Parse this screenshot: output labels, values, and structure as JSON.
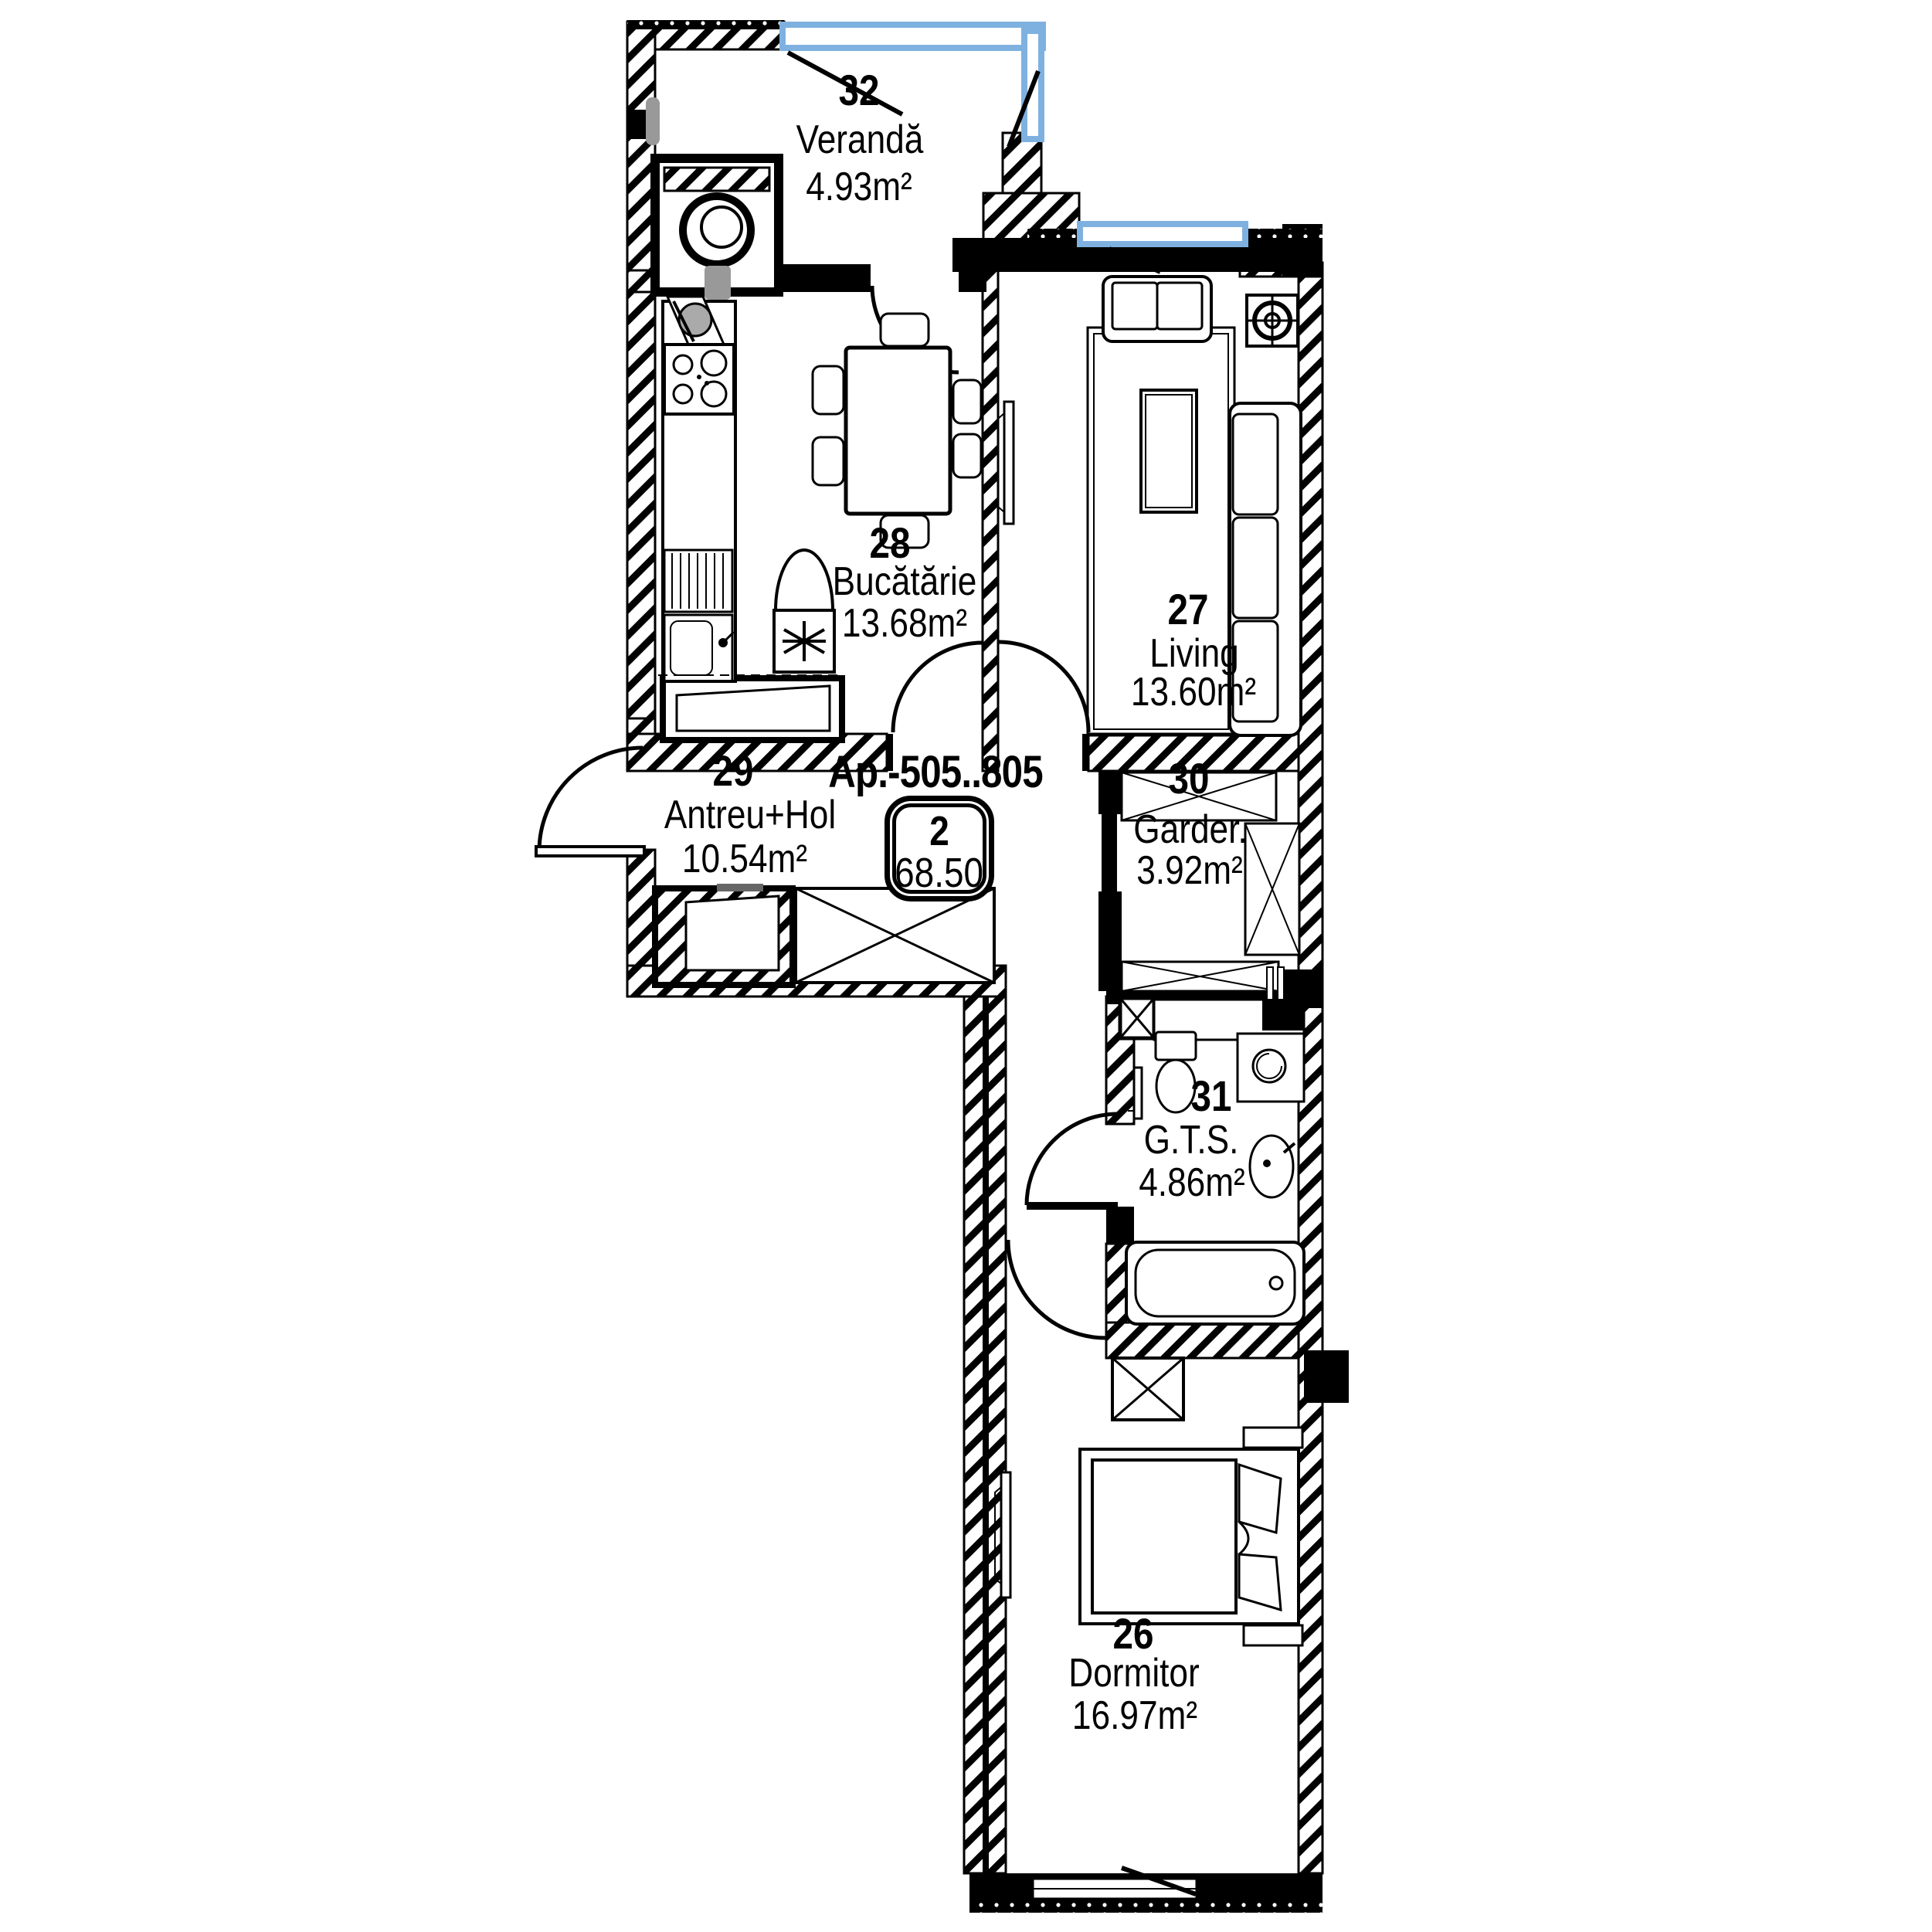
{
  "apartment": {
    "label": "Ap.-505..805",
    "badge": {
      "room_count": "2",
      "total_area": "68.50"
    }
  },
  "rooms": [
    {
      "number": "26",
      "name": "Dormitor",
      "area": "16.97m²"
    },
    {
      "number": "27",
      "name": "Living",
      "area": "13.60m²"
    },
    {
      "number": "28",
      "name": "Bucătărie",
      "area": "13.68m²"
    },
    {
      "number": "29",
      "name": "Antreu+Hol",
      "area": "10.54m²"
    },
    {
      "number": "30",
      "name": "Garder.",
      "area": "3.92m²"
    },
    {
      "number": "31",
      "name": "G.T.S.",
      "area": "4.86m²"
    },
    {
      "number": "32",
      "name": "Verandă",
      "area": "4.93m²"
    }
  ],
  "colors": {
    "wall": "#000000",
    "window_glazing": "#7fb1e0",
    "background": "#ffffff",
    "fixture_gray": "#999999"
  }
}
